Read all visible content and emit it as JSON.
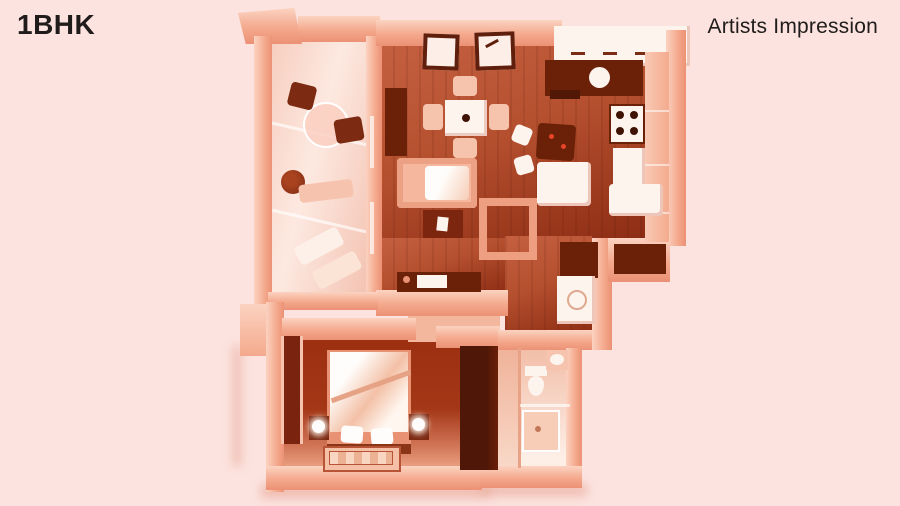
{
  "header": {
    "title": "1BHK",
    "annotation": "Artists Impression"
  },
  "palette": {
    "bg": "#fce3df",
    "ink": "#201c1b",
    "wall-hi": "#fbd3c1",
    "wall": "#f4a98d",
    "wall-deep": "#ec9175",
    "wood": "#b5502f",
    "wood-lite": "#c46040",
    "wood-dark": "#8a2a12",
    "maroon": "#6b2008",
    "dark": "#521806",
    "bed-floor": "#9c2f10",
    "light-floor": "#f6cdbd",
    "pass-floor": "#f2b79c",
    "white": "#fdf4ee",
    "accent-red": "#e8442a"
  },
  "floorplan": {
    "view": "3d-top-down-apartment-render",
    "tint": "monochrome-salmon",
    "rooms": [
      {
        "name": "balcony",
        "furniture": [
          "bistro-table",
          "two-dark-chairs",
          "potted-plant",
          "bench",
          "two-lounge-chairs"
        ]
      },
      {
        "name": "living-dining",
        "furniture": [
          "two-wall-frames",
          "bookshelf",
          "dining-table-for-four",
          "sofa",
          "coffee-table",
          "side-table",
          "tv-unit",
          "floor-rug"
        ]
      },
      {
        "name": "kitchen",
        "furniture": [
          "l-shaped-counter",
          "round-sink",
          "four-burner-hob",
          "tall-units-refrigerator",
          "island-counter",
          "white-cabinet",
          "washing-machine",
          "storage-niche"
        ]
      },
      {
        "name": "bedroom",
        "furniture": [
          "double-bed-white-duvet",
          "two-pillows",
          "two-nightstand-lamps",
          "rug",
          "window",
          "dark-wardrobe"
        ]
      },
      {
        "name": "bathroom",
        "furniture": [
          "toilet",
          "washbasin",
          "shower-area",
          "glass-partition"
        ]
      }
    ]
  }
}
